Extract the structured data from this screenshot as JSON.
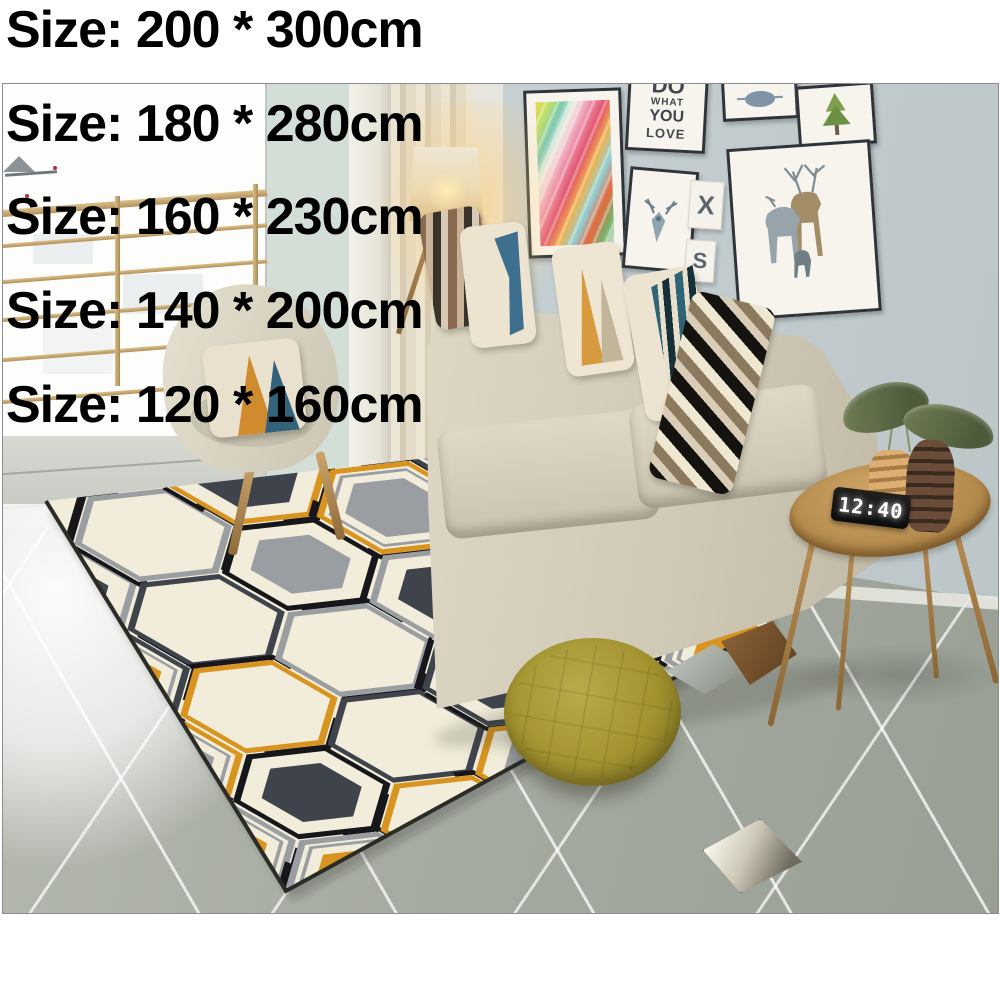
{
  "page": {
    "background": "#ffffff"
  },
  "size_labels": [
    "Size: 200 * 300cm",
    "Size: 180 * 280cm",
    "Size: 160 * 230cm",
    "Size: 140 * 200cm",
    "Size: 120 * 160cm"
  ],
  "photo": {
    "description": "Scandinavian living room with geometric hexagon area rug, beige sofa, armchair, floor lamp, gallery wall and side table",
    "clock_time": "12:40",
    "wall_art": {
      "typography_lines": [
        "DO",
        "WHAT",
        "YOU",
        "LOVE"
      ],
      "letter_tile_top": "X",
      "letter_tile_bottom": "S"
    },
    "palette": {
      "rug_cream": "#f2edda",
      "rug_orange": "#d8941f",
      "rug_charcoal": "#3f444c",
      "rug_gray": "#9a9ea2",
      "rug_black": "#16161b",
      "pouf_olive": "#a79a3d",
      "sofa_beige": "#d3cdba",
      "wall_gray_blue": "#c6cfd1",
      "wall_mint": "#d3ded7",
      "floor_gray": "#a7aba1",
      "table_wood": "#b78c4f"
    }
  }
}
